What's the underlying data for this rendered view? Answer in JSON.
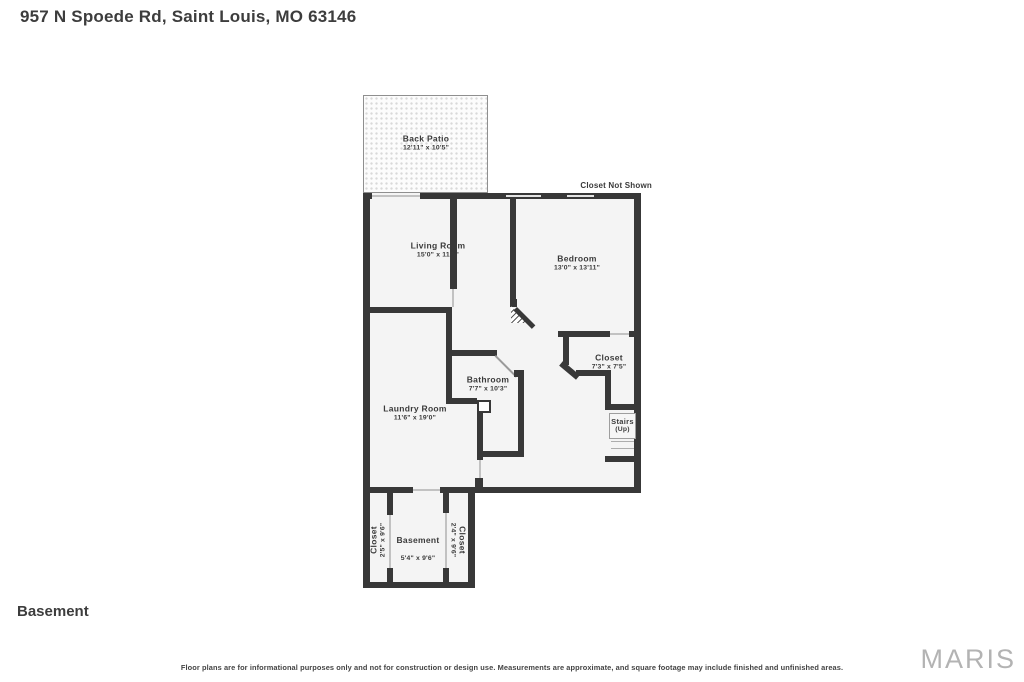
{
  "header": {
    "address": "957 N Spoede Rd, Saint Louis, MO 63146"
  },
  "plan": {
    "annotation_closet_not_shown": "Closet Not Shown",
    "rooms": {
      "back_patio": {
        "name": "Back Patio",
        "dims": "12'11\" x 10'5\""
      },
      "living_room": {
        "name": "Living Room",
        "dims": "15'0\" x 11'5\""
      },
      "bedroom": {
        "name": "Bedroom",
        "dims": "13'0\" x 13'11\""
      },
      "closet": {
        "name": "Closet",
        "dims": "7'3\" x 7'5\""
      },
      "bathroom": {
        "name": "Bathroom",
        "dims": "7'7\" x 10'3\""
      },
      "laundry": {
        "name": "Laundry Room",
        "dims": "11'6\" x 19'0\""
      },
      "stairs": {
        "name": "Stairs",
        "sub": "(Up)"
      },
      "basement": {
        "name": "Basement",
        "dims": "5'4\" x 9'6\""
      },
      "closet_left": {
        "name": "Closet",
        "dims": "2'5\" x 9'6\""
      },
      "closet_right": {
        "name": "Closet",
        "dims": "2'4\" x 9'6\""
      }
    }
  },
  "floor_label": "Basement",
  "footer": {
    "disclaimer": "Floor plans are for informational purposes only and not for construction or design use. Measurements are approximate, and square footage may include finished and unfinished areas.",
    "brand": "MARIS"
  },
  "colors": {
    "wall": "#383838",
    "room_fill": "#f4f4f4",
    "brand_gray": "#b3b3b3"
  }
}
